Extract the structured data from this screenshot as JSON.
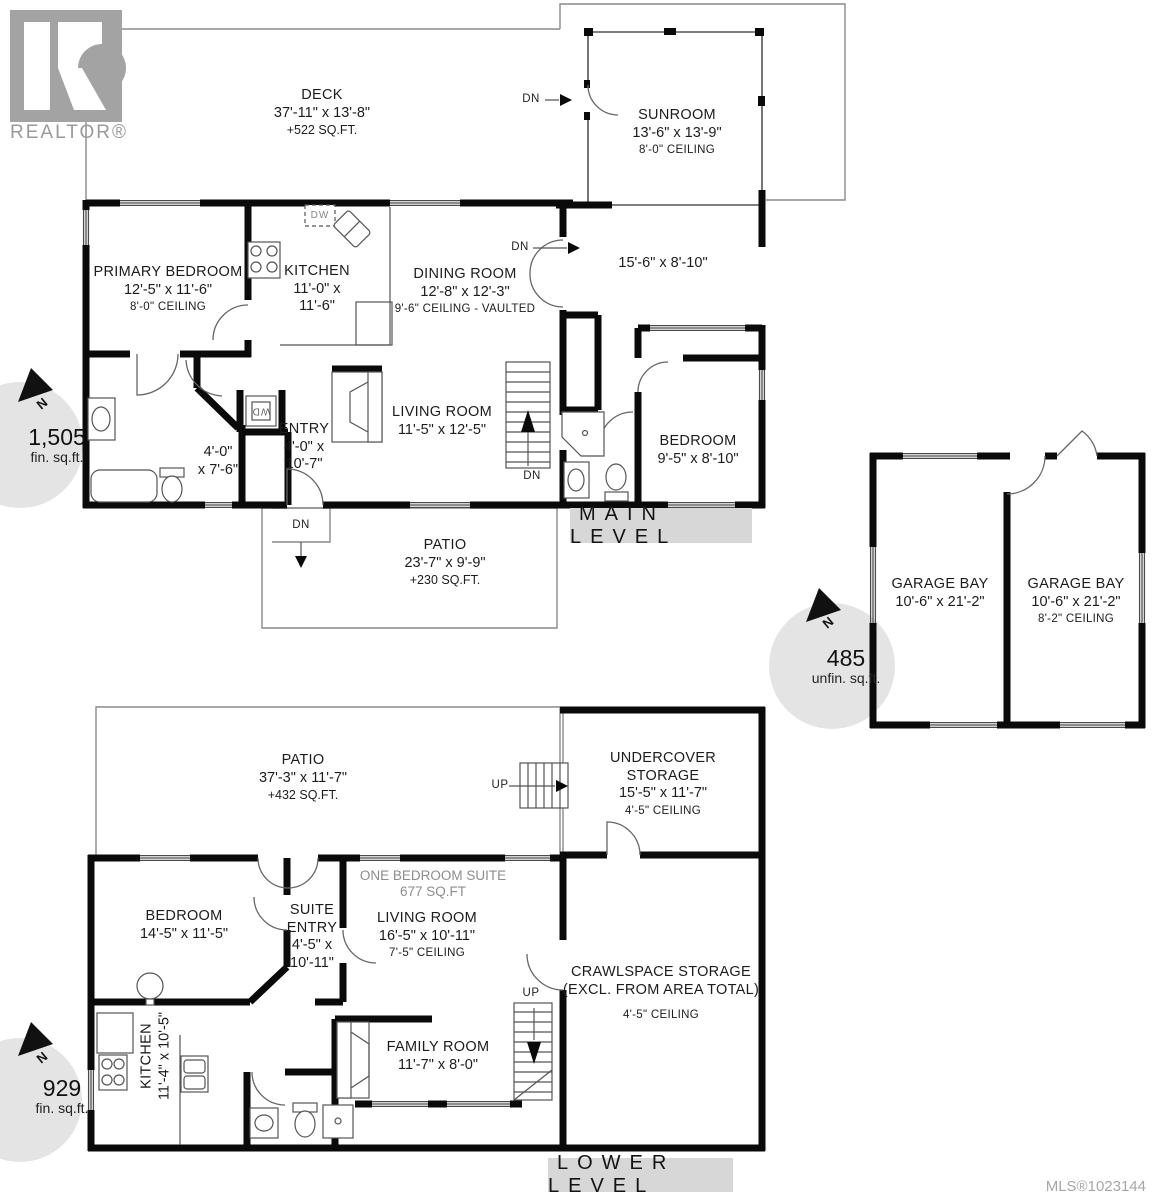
{
  "branding": {
    "logo_letter": "R",
    "logo_caption": "REALTOR®"
  },
  "footer": {
    "mls": "MLS®1023144"
  },
  "badges": {
    "north": "N",
    "main": {
      "value": "1,505",
      "unit": "fin. sq.ft."
    },
    "garage": {
      "value": "485",
      "unit": "unfin. sq.ft."
    },
    "lower": {
      "value": "929",
      "unit": "fin. sq.ft."
    }
  },
  "main_level": {
    "label": "MAIN LEVEL",
    "dn": "DN",
    "wd": "WD",
    "dw": "DW",
    "deck": {
      "name": "DECK",
      "dims": "37'-11\" x 13'-8\"",
      "area": "+522 SQ.FT."
    },
    "sunroom": {
      "name": "SUNROOM",
      "dims": "13'-6\" x 13'-9\"",
      "ceiling": "8'-0\" CEILING"
    },
    "wing_dims": "15'-6\" x 8'-10\"",
    "primary_bedroom": {
      "name": "PRIMARY BEDROOM",
      "dims": "12'-5\" x 11'-6\"",
      "ceiling": "8'-0\" CEILING"
    },
    "kitchen": {
      "name": "KITCHEN",
      "dims1": "11'-0\" x",
      "dims2": "11'-6\""
    },
    "dining_room": {
      "name": "DINING ROOM",
      "dims": "12'-8\" x 12'-3\"",
      "ceiling": "9'-6\" CEILING - VAULTED"
    },
    "hall": {
      "dims1": "4'-0\"",
      "dims2": "x 7'-6\""
    },
    "entry": {
      "name": "ENTRY",
      "dims1": "4'-0\" x",
      "dims2": "10'-7\""
    },
    "living_room": {
      "name": "LIVING ROOM",
      "dims": "11'-5\" x 12'-5\""
    },
    "bedroom": {
      "name": "BEDROOM",
      "dims": "9'-5\" x 8'-10\""
    },
    "patio": {
      "name": "PATIO",
      "dims": "23'-7\" x 9'-9\"",
      "area": "+230 SQ.FT."
    }
  },
  "garage": {
    "bay_left": {
      "name": "GARAGE BAY",
      "dims": "10'-6\" x 21'-2\""
    },
    "bay_right": {
      "name": "GARAGE BAY",
      "dims": "10'-6\" x 21'-2\"",
      "ceiling": "8'-2\" CEILING"
    }
  },
  "lower_level": {
    "label": "LOWER LEVEL",
    "up": "UP",
    "patio": {
      "name": "PATIO",
      "dims": "37'-3\" x 11'-7\"",
      "area": "+432 SQ.FT."
    },
    "undercover_storage": {
      "name1": "UNDERCOVER",
      "name2": "STORAGE",
      "dims": "15'-5\" x 11'-7\"",
      "ceiling": "4'-5\" CEILING"
    },
    "suite_title": {
      "line1": "ONE BEDROOM SUITE",
      "line2": "677 SQ.FT"
    },
    "bedroom": {
      "name": "BEDROOM",
      "dims": "14'-5\" x 11'-5\""
    },
    "suite_entry": {
      "name1": "SUITE",
      "name2": "ENTRY",
      "dims1": "4'-5\" x",
      "dims2": "10'-11\""
    },
    "living_room": {
      "name": "LIVING ROOM",
      "dims": "16'-5\" x 10'-11\"",
      "ceiling": "7'-5\" CEILING"
    },
    "crawlspace": {
      "name": "CRAWLSPACE STORAGE",
      "note": "(EXCL. FROM AREA TOTAL)",
      "ceiling": "4'-5\" CEILING"
    },
    "kitchen": {
      "name": "KITCHEN",
      "dims": "11'-4\" x 10'-5\""
    },
    "family_room": {
      "name": "FAMILY ROOM",
      "dims": "11'-7\" x 8'-0\""
    }
  }
}
